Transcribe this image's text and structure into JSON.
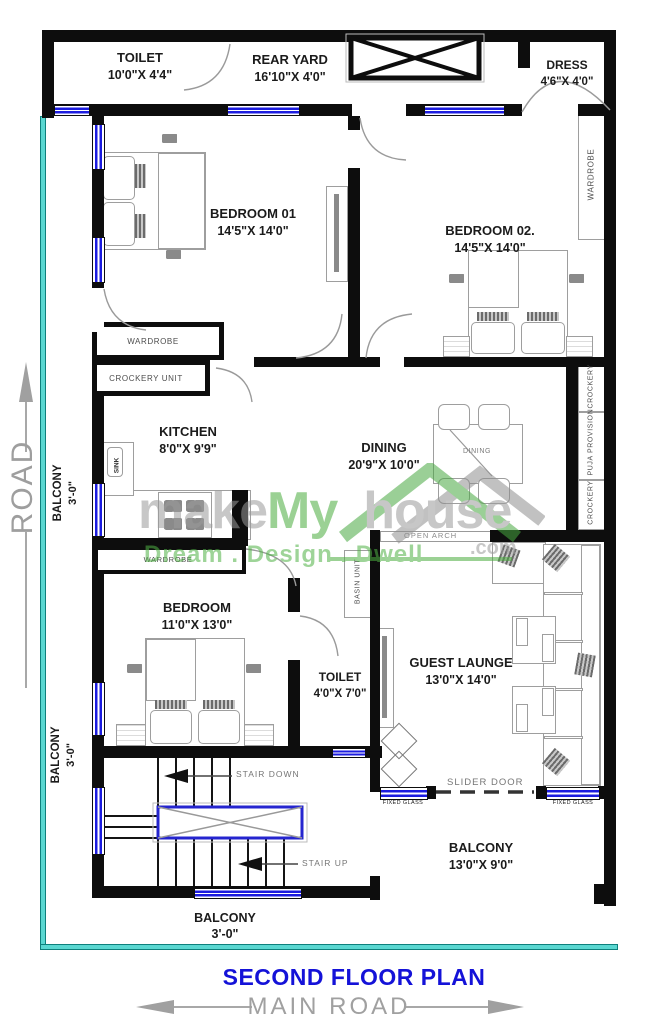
{
  "footer": {
    "title": "SECOND FLOOR PLAN",
    "road": "MAIN ROAD"
  },
  "side": {
    "road": "ROAD"
  },
  "watermark": {
    "p1": "make",
    "p2": "My",
    "p3": "house",
    "com": ".com",
    "tagline": "Dream . Design . Dwell"
  },
  "rooms": {
    "toilet_top": {
      "name": "TOILET",
      "dims": "10'0\"X 4'4\""
    },
    "rear_yard": {
      "name": "REAR YARD",
      "dims": "16'10\"X 4'0\""
    },
    "dress": {
      "name": "DRESS",
      "dims": "4'6\"X 4'0\""
    },
    "bedroom01": {
      "name": "BEDROOM 01",
      "dims": "14'5\"X 14'0\""
    },
    "bedroom02": {
      "name": "BEDROOM 02.",
      "dims": "14'5\"X 14'0\""
    },
    "kitchen": {
      "name": "KITCHEN",
      "dims": "8'0\"X 9'9\""
    },
    "dining": {
      "name": "DINING",
      "dims": "20'9\"X 10'0\""
    },
    "bedroom3": {
      "name": "BEDROOM",
      "dims": "11'0\"X 13'0\""
    },
    "toilet_small": {
      "name": "TOILET",
      "dims": "4'0\"X 7'0\""
    },
    "guest_launge": {
      "name": "GUEST LAUNGE",
      "dims": "13'0\"X 14'0\""
    },
    "balcony_right": {
      "name": "BALCONY",
      "dims": "13'0\"X 9'0\""
    },
    "balcony_bottom": {
      "name": "BALCONY",
      "dims": "3'-0\""
    },
    "balcony_left_up": {
      "name": "BALCONY",
      "dims": "3'-0\""
    },
    "balcony_left_low": {
      "name": "BALCONY",
      "dims": "3'-0\""
    }
  },
  "fixtures": {
    "wardrobe_right": "WARDROBE",
    "wardrobe_bed01": "WARDROBE",
    "crockery_unit": "CROCKERY UNIT",
    "wardrobe_bed3": "WARDROBE",
    "sink": "SINK",
    "dining_table": "DINING",
    "crockery_a": "CROCKERY",
    "puja": "PUJA PROVISION",
    "crockery_b": "CROCKERY",
    "basin": "BASIN UNIT",
    "open_arch": "OPEN ARCH",
    "stair_down": "STAIR DOWN",
    "stair_up": "STAIR UP",
    "slider_door": "SLIDER DOOR",
    "fixed_glass_a": "FIXED GLASS",
    "fixed_glass_b": "FIXED GLASS"
  },
  "colors": {
    "wall": "#0d0d0d",
    "window_blue": "#1c1cdf",
    "road_teal": "#5ad7d1",
    "title_blue": "#1412d8",
    "road_gray": "#a0a0a0",
    "watermark_green": "#4aad3e",
    "watermark_gray": "#9b9b9b",
    "shaft_blue": "#2525cf"
  }
}
